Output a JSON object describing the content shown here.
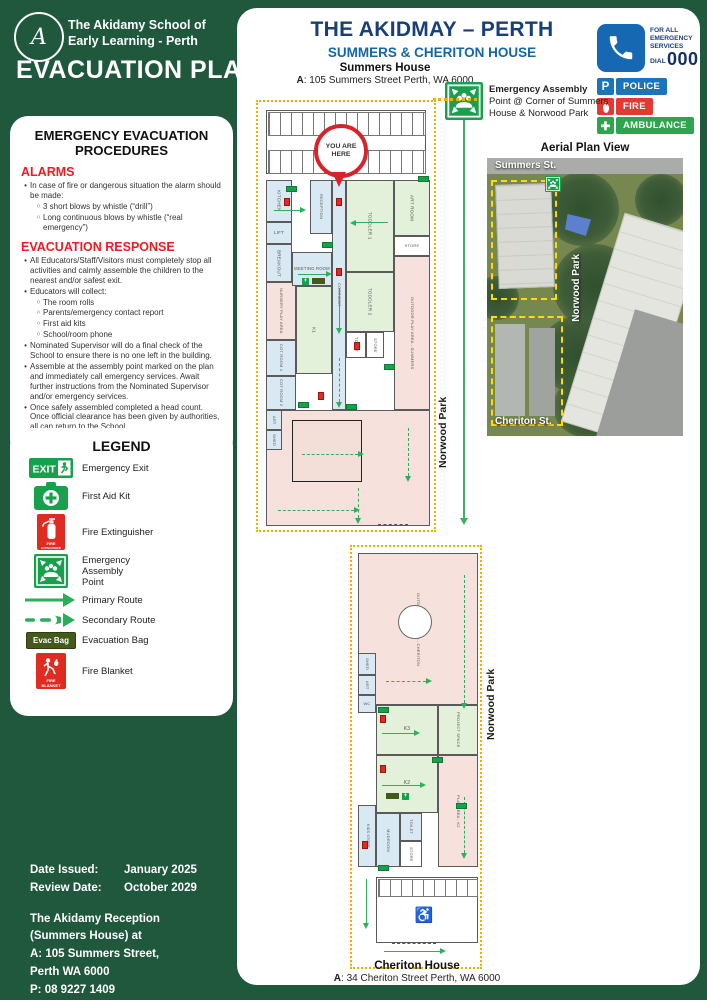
{
  "brand": {
    "org_name": "The Akidamy School of Early Learning - Perth",
    "logo_letter": "A",
    "doc_title": "EVACUATION PLAN"
  },
  "procedures": {
    "title": "EMERGENCY EVACUATION PROCEDURES",
    "alarms_heading": "ALARMS",
    "alarms": [
      {
        "text": "In case of fire or dangerous situation the alarm should be made:",
        "subs": [
          "3 short blows by whistle (“drill”)",
          "Long continuous blows by whistle (“real emergency”)"
        ]
      }
    ],
    "response_heading": "EVACUATION RESPONSE",
    "response": [
      {
        "text": "All Educators/Staff/Visitors must completely stop all activities and calmly assemble the children to the nearest and/or safest exit."
      },
      {
        "text": "Educators will collect:",
        "subs": [
          "The room rolls",
          "Parents/emergency contact report",
          "First aid kits",
          "School/room phone"
        ]
      },
      {
        "text": "Nominated Supervisor will do a final check of the School to ensure there is no one left in the building."
      },
      {
        "text": "Assemble at the assembly point marked on the plan and immediately call emergency services. Await further instructions from the Nominated Supervisor and/or emergency services."
      },
      {
        "text": "Once safely assembled completed a head count. Once official clearance has been given by authorities, all can return to the School."
      }
    ]
  },
  "legend": {
    "title": "LEGEND",
    "items": [
      {
        "icon": "emergency-exit-icon",
        "label": "Emergency Exit"
      },
      {
        "icon": "first-aid-icon",
        "label": "First Aid Kit"
      },
      {
        "icon": "fire-extinguisher-icon",
        "label": "Fire Extinguisher"
      },
      {
        "icon": "assembly-point-icon",
        "label": "Emergency\nAssembly\nPoint"
      },
      {
        "icon": "primary-route-icon",
        "label": "Primary Route"
      },
      {
        "icon": "secondary-route-icon",
        "label": "Secondary Route"
      },
      {
        "icon": "evac-bag-icon",
        "label": "Evacuation Bag",
        "badge_text": "Evac Bag"
      },
      {
        "icon": "fire-blanket-icon",
        "label": "Fire Blanket"
      }
    ]
  },
  "footer": {
    "rows": [
      {
        "label": "Date Issued:",
        "value": "January 2025"
      },
      {
        "label": "Review Date:",
        "value": "October 2029"
      }
    ],
    "reception_lines": [
      "The Akidamy Reception",
      "(Summers House) at",
      "A: 105 Summers Street,",
      "Perth WA 6000",
      "P: 08 9227 1409"
    ]
  },
  "main": {
    "title": "THE AKIDMAY – PERTH",
    "subtitle": "SUMMERS & CHERITON HOUSE",
    "summers": {
      "name": "Summers House",
      "addr_label": "A",
      "addr_rest": ": 105 Summers Street Perth, WA 6000"
    },
    "cheriton": {
      "name": "Cheriton House",
      "addr_label": "A",
      "addr_rest": ": 34 Cheriton Street Perth,  WA 6000"
    },
    "assembly_note": {
      "bold": "Emergency Assembly",
      "rest": " Point @ Corner of Summers House & Norwood Park"
    },
    "aerial": {
      "title": "Aerial Plan View",
      "summers_st": "Summers St.",
      "norwood": "Norwood Park",
      "cheriton_st": "Cheriton St."
    },
    "norwood_park": "Norwood Park",
    "you_are_here": "YOU ARE\nHERE",
    "emergency": {
      "for_all": "FOR ALL\nEMERGENCY\nSERVICES",
      "dial": "DIAL",
      "number": "000",
      "tile_color": "#1668b3",
      "services": [
        {
          "type": "police",
          "label": "POLICE",
          "color": "#1b74ba"
        },
        {
          "type": "fire",
          "label": "FIRE",
          "color": "#e23a33"
        },
        {
          "type": "ambulance",
          "label": "AMBULANCE",
          "color": "#2fa44e"
        }
      ]
    },
    "summers_plan": {
      "rooms": [
        {
          "n": "PARKING",
          "c": "w",
          "x": 8,
          "y": 8,
          "w": 160,
          "h": 64,
          "v": true
        },
        {
          "n": "",
          "c": "p",
          "x": 8,
          "y": 308,
          "w": 164,
          "h": 116
        },
        {
          "n": "KITCHEN",
          "c": "b",
          "x": 8,
          "y": 78,
          "w": 26,
          "h": 42,
          "v": true
        },
        {
          "n": "LIFT",
          "c": "b",
          "x": 8,
          "y": 120,
          "w": 26,
          "h": 22
        },
        {
          "n": "BREAKOUT",
          "c": "b",
          "x": 8,
          "y": 142,
          "w": 26,
          "h": 38,
          "v": true
        },
        {
          "n": "NURSERY PLAY AREA",
          "c": "p",
          "x": 8,
          "y": 180,
          "w": 30,
          "h": 58,
          "v": true,
          "fs": 4
        },
        {
          "n": "COT ROOM 1",
          "c": "b",
          "x": 8,
          "y": 238,
          "w": 30,
          "h": 36,
          "v": true,
          "fs": 4
        },
        {
          "n": "COT ROOM 2",
          "c": "b",
          "x": 8,
          "y": 274,
          "w": 30,
          "h": 34,
          "v": true,
          "fs": 4
        },
        {
          "n": "ART",
          "c": "b",
          "x": 8,
          "y": 308,
          "w": 16,
          "h": 20,
          "v": true,
          "fs": 4
        },
        {
          "n": "SHED",
          "c": "b",
          "x": 8,
          "y": 328,
          "w": 16,
          "h": 20,
          "v": true,
          "fs": 4
        },
        {
          "n": "RECEPTION",
          "c": "b",
          "x": 52,
          "y": 78,
          "w": 22,
          "h": 54,
          "v": true,
          "fs": 4
        },
        {
          "n": "MEETING ROOM",
          "c": "b",
          "x": 34,
          "y": 150,
          "w": 40,
          "h": 34,
          "fs": 4.2
        },
        {
          "n": "K1",
          "c": "g",
          "x": 38,
          "y": 184,
          "w": 36,
          "h": 88,
          "v": true
        },
        {
          "n": "CORRIDOR",
          "c": "b",
          "x": 74,
          "y": 78,
          "w": 14,
          "h": 230,
          "v": true,
          "fs": 4
        },
        {
          "n": "TODDLER 1",
          "c": "g",
          "x": 88,
          "y": 78,
          "w": 48,
          "h": 92,
          "v": true
        },
        {
          "n": "ART ROOM",
          "c": "g",
          "x": 136,
          "y": 78,
          "w": 36,
          "h": 56,
          "v": true
        },
        {
          "n": "STORE",
          "c": "w",
          "x": 136,
          "y": 134,
          "w": 36,
          "h": 20,
          "fs": 4
        },
        {
          "n": "TODDLER 2",
          "c": "g",
          "x": 88,
          "y": 170,
          "w": 48,
          "h": 60,
          "v": true
        },
        {
          "n": "TOILET",
          "c": "w",
          "x": 88,
          "y": 230,
          "w": 20,
          "h": 26,
          "v": true,
          "fs": 4
        },
        {
          "n": "STORE",
          "c": "w",
          "x": 108,
          "y": 230,
          "w": 18,
          "h": 26,
          "v": true,
          "fs": 4
        },
        {
          "n": "OUTDOOR PLAY AREA - SUMMERS",
          "c": "p",
          "x": 136,
          "y": 154,
          "w": 36,
          "h": 154,
          "v": true,
          "fs": 4
        }
      ],
      "extras": [
        {
          "cls": "comb",
          "x": 10,
          "y": 10,
          "w": 156,
          "h": 22
        },
        {
          "cls": "comb",
          "x": 10,
          "y": 48,
          "w": 156,
          "h": 22
        },
        {
          "cls": "deck",
          "x": 34,
          "y": 318,
          "w": 68,
          "h": 60
        },
        {
          "cls": "gate",
          "x": 120,
          "y": 422,
          "w": 30,
          "h": 0
        }
      ],
      "icons": [
        {
          "t": "exit",
          "x": 28,
          "y": 84
        },
        {
          "t": "exit",
          "x": 64,
          "y": 140
        },
        {
          "t": "exit",
          "x": 160,
          "y": 74
        },
        {
          "t": "exit",
          "x": 126,
          "y": 262
        },
        {
          "t": "exit",
          "x": 40,
          "y": 300
        },
        {
          "t": "exit",
          "x": 88,
          "y": 302
        },
        {
          "t": "fe",
          "x": 26,
          "y": 96
        },
        {
          "t": "fe",
          "x": 78,
          "y": 166
        },
        {
          "t": "fe",
          "x": 96,
          "y": 240
        },
        {
          "t": "fe",
          "x": 60,
          "y": 290
        },
        {
          "t": "fe",
          "x": 78,
          "y": 96
        },
        {
          "t": "fa",
          "x": 44,
          "y": 176
        },
        {
          "t": "eb",
          "x": 54,
          "y": 176
        }
      ],
      "arrows": [
        {
          "o": "h",
          "x": 16,
          "y": 108,
          "l": 26
        },
        {
          "o": "h",
          "x": 98,
          "y": 120,
          "l": 32,
          "f": true
        },
        {
          "o": "h",
          "x": 40,
          "y": 172,
          "l": 28
        },
        {
          "o": "v",
          "x": 81,
          "y": 186,
          "l": 40
        },
        {
          "o": "v",
          "x": 81,
          "y": 256,
          "l": 44,
          "d": true
        },
        {
          "o": "h",
          "x": 44,
          "y": 352,
          "l": 56,
          "d": true
        },
        {
          "o": "v",
          "x": 150,
          "y": 326,
          "l": 48,
          "d": true
        },
        {
          "o": "v",
          "x": 100,
          "y": 386,
          "l": 30,
          "d": true
        },
        {
          "o": "h",
          "x": 20,
          "y": 408,
          "l": 76,
          "d": true
        }
      ]
    },
    "cheriton_plan": {
      "rooms": [
        {
          "n": "OUTDOOR PLAY AREA - CHERITON",
          "c": "p",
          "x": 6,
          "y": 6,
          "w": 120,
          "h": 152,
          "v": true,
          "fs": 4
        },
        {
          "n": "SHED",
          "c": "b",
          "x": 6,
          "y": 106,
          "w": 18,
          "h": 22,
          "v": true,
          "fs": 4
        },
        {
          "n": "ART",
          "c": "b",
          "x": 6,
          "y": 128,
          "w": 18,
          "h": 20,
          "v": true,
          "fs": 4
        },
        {
          "n": "WC",
          "c": "b",
          "x": 6,
          "y": 148,
          "w": 18,
          "h": 18,
          "fs": 4
        },
        {
          "n": "K3",
          "c": "g",
          "x": 24,
          "y": 158,
          "w": 62,
          "h": 50,
          "fs": 5
        },
        {
          "n": "PROJECT SPACE",
          "c": "g",
          "x": 86,
          "y": 158,
          "w": 40,
          "h": 50,
          "v": true,
          "fs": 4
        },
        {
          "n": "K2",
          "c": "g",
          "x": 24,
          "y": 208,
          "w": 62,
          "h": 58,
          "fs": 5
        },
        {
          "n": "PLAY AREA - K2",
          "c": "p",
          "x": 86,
          "y": 208,
          "w": 40,
          "h": 112,
          "v": true,
          "fs": 4
        },
        {
          "n": "KIDS STORE",
          "c": "b",
          "x": 6,
          "y": 258,
          "w": 18,
          "h": 62,
          "v": true,
          "fs": 3.6
        },
        {
          "n": "MUDROOM",
          "c": "b",
          "x": 24,
          "y": 266,
          "w": 24,
          "h": 54,
          "v": true,
          "fs": 4
        },
        {
          "n": "TOILET",
          "c": "b",
          "x": 48,
          "y": 266,
          "w": 22,
          "h": 28,
          "v": true,
          "fs": 4
        },
        {
          "n": "STORE",
          "c": "w",
          "x": 48,
          "y": 294,
          "w": 22,
          "h": 26,
          "v": true,
          "fs": 4
        },
        {
          "n": "",
          "c": "w",
          "x": 24,
          "y": 330,
          "w": 102,
          "h": 66
        }
      ],
      "extras": [
        {
          "cls": "sand",
          "x": 46,
          "y": 58,
          "w": 32,
          "h": 32
        },
        {
          "cls": "comb",
          "x": 26,
          "y": 332,
          "w": 98,
          "h": 16
        },
        {
          "cls": "dis",
          "x": 60,
          "y": 356,
          "w": 24,
          "h": 24,
          "t": "♿"
        },
        {
          "cls": "gate",
          "x": 40,
          "y": 396,
          "w": 44,
          "h": 0
        }
      ],
      "icons": [
        {
          "t": "exit",
          "x": 26,
          "y": 160
        },
        {
          "t": "exit",
          "x": 80,
          "y": 210
        },
        {
          "t": "exit",
          "x": 26,
          "y": 318
        },
        {
          "t": "exit",
          "x": 104,
          "y": 256
        },
        {
          "t": "fe",
          "x": 28,
          "y": 168
        },
        {
          "t": "fe",
          "x": 28,
          "y": 218
        },
        {
          "t": "fe",
          "x": 10,
          "y": 294
        },
        {
          "t": "eb",
          "x": 34,
          "y": 246
        },
        {
          "t": "fa",
          "x": 50,
          "y": 246
        }
      ],
      "arrows": [
        {
          "o": "h",
          "x": 30,
          "y": 186,
          "l": 32
        },
        {
          "o": "h",
          "x": 30,
          "y": 238,
          "l": 38
        },
        {
          "o": "v",
          "x": 112,
          "y": 28,
          "l": 128,
          "d": true
        },
        {
          "o": "v",
          "x": 112,
          "y": 250,
          "l": 56,
          "d": true
        },
        {
          "o": "h",
          "x": 32,
          "y": 404,
          "l": 56
        },
        {
          "o": "v",
          "x": 14,
          "y": 332,
          "l": 44
        },
        {
          "o": "h",
          "x": 34,
          "y": 134,
          "l": 40,
          "d": true
        }
      ]
    }
  }
}
